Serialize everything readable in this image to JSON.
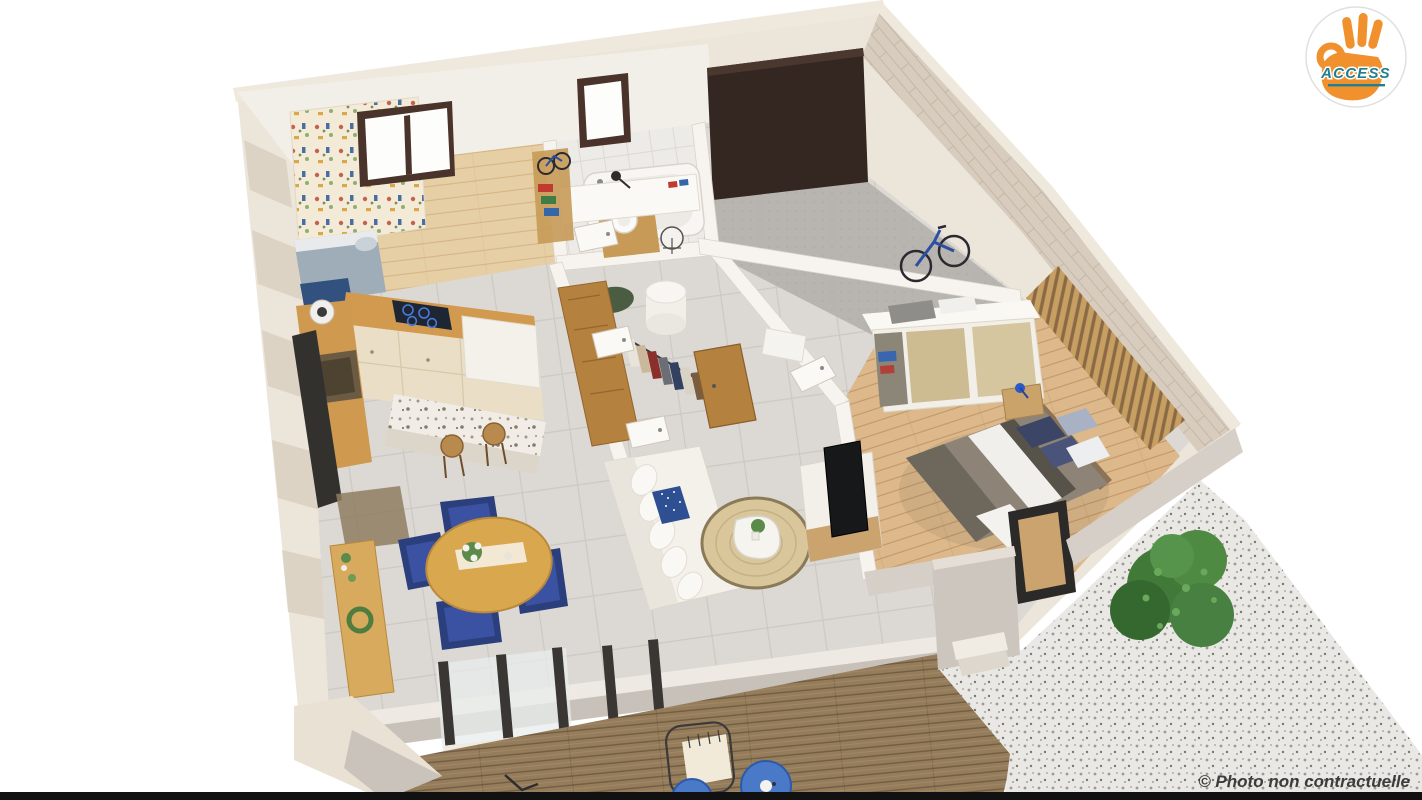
{
  "logo": {
    "text": "ACCESS",
    "text_color": "#1f7f91",
    "hand_color": "#f0912d",
    "bg_color": "#ffffff",
    "icon": "ok-hand-icon"
  },
  "watermark": {
    "text": "© Photo non contractuelle",
    "color": "#262626"
  },
  "palette": {
    "background": "#ffffff",
    "exterior_wall": "#ece5d9",
    "interior_wall": "#f6f3ee",
    "tile_floor": "#dcd9d4",
    "wood_floor_kids": "#e7cfa5",
    "wood_floor_bedroom": "#dcb88b",
    "garage_floor": "#b8b4af",
    "garage_door": "#342621",
    "brick_wall": "#d7ccbd",
    "slat_wall": "#c89f63",
    "kitchen_wood": "#d29a4e",
    "cabinet_cream": "#eadfc6",
    "deck_wood": "#957d5c",
    "gravel": "#eae8e4",
    "rug_jute": "#d9c69b",
    "sofa_white": "#f4f1eb",
    "accent_navy": "#2c3f7d",
    "bed_duvet_gray": "#8d8477",
    "bush_green": "#417a38",
    "bottom_bar": "#111111"
  },
  "scene": {
    "rooms": [
      {
        "name": "kids-bedroom"
      },
      {
        "name": "bathroom"
      },
      {
        "name": "garage"
      },
      {
        "name": "hallway-closet"
      },
      {
        "name": "master-bedroom"
      },
      {
        "name": "kitchen"
      },
      {
        "name": "living-dining"
      },
      {
        "name": "wood-deck"
      },
      {
        "name": "gravel-patio"
      }
    ]
  }
}
